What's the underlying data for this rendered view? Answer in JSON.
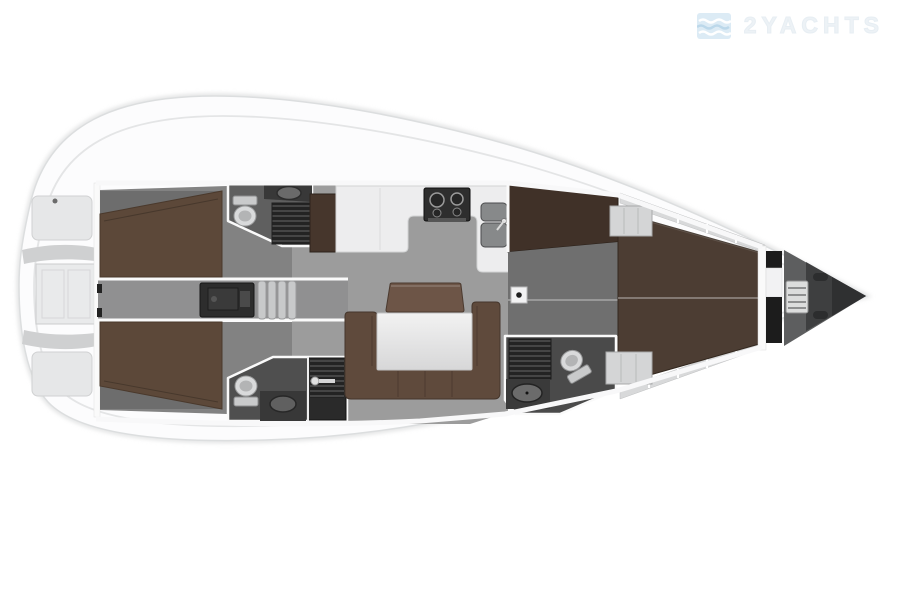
{
  "watermark": {
    "brand": "2YACHTS",
    "icon": "waves-logo-icon"
  },
  "floor_plan": {
    "type": "sailing-yacht-interior-layout-top-view",
    "orientation": {
      "bow": "right",
      "stern": "left"
    },
    "rooms": [
      {
        "name": "stern-transom",
        "features": [
          "stowage-panels",
          "transom-door"
        ]
      },
      {
        "name": "aft-cabin-port",
        "features": [
          "double-berth"
        ]
      },
      {
        "name": "aft-cabin-starboard",
        "features": [
          "double-berth"
        ]
      },
      {
        "name": "aft-head-port",
        "features": [
          "toilet",
          "sink",
          "shower-grate"
        ]
      },
      {
        "name": "aft-head-starboard",
        "features": [
          "toilet",
          "sink",
          "shower-cabin"
        ]
      },
      {
        "name": "companionway",
        "features": [
          "steps",
          "engine-compartment"
        ]
      },
      {
        "name": "salon",
        "features": [
          "u-shaped-sofa",
          "table",
          "backrest-seat"
        ]
      },
      {
        "name": "galley",
        "features": [
          "stove",
          "double-sink",
          "counter",
          "chart-table"
        ]
      },
      {
        "name": "forward-dressing-area",
        "features": [
          "wardrobe",
          "mast-post"
        ]
      },
      {
        "name": "forward-head",
        "features": [
          "toilet",
          "sink",
          "shower-grate"
        ]
      },
      {
        "name": "forward-cabin",
        "features": [
          "v-berth",
          "side-shelves",
          "foot-lockers"
        ]
      },
      {
        "name": "anchor-locker",
        "features": [
          "windlass",
          "deck-handles"
        ]
      }
    ],
    "colors": {
      "background": "#ffffff",
      "hull": "#fcfcfd",
      "hull_outline": "#dcdedf",
      "deck_line": "#e4e5e6",
      "floor": "#9c9c9c",
      "floor_dark": "#6f6f6f",
      "head_floor": "#565656",
      "berth_brown": "#5c4839",
      "v_berth_brown": "#4c3d33",
      "sofa_brown": "#5f4a3c",
      "backrest_brown": "#6d5547",
      "cabinet_brown": "#46362c",
      "counter_white": "#ededee",
      "table_white": "#e6e6e6",
      "appliance_dark": "#2f2f2f",
      "grate_dark": "#232323",
      "logo_blue": "#d8e9f4",
      "logo_text": "#eef3f7"
    }
  }
}
